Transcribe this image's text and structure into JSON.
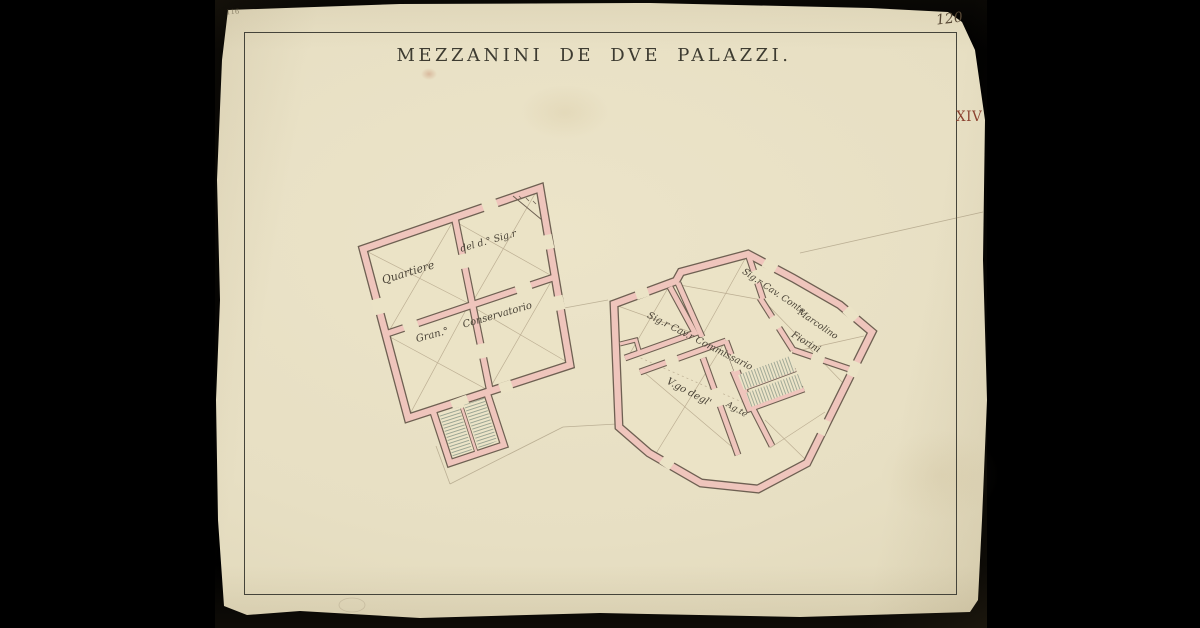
{
  "document": {
    "title": "MEZZANINI DE DVE PALAZZI.",
    "page_number": "120",
    "plate_number": "XIV",
    "corner_mark": "116",
    "type_note": "scanned archival floor-plan drawing of the mezzanines of two palaces"
  },
  "left_plan": {
    "rooms": {
      "quartiere": "Quartiere",
      "del_sig": "del d.° Sig.r",
      "gran": "Gran.°",
      "conservatorio": "Conservatorio"
    }
  },
  "right_plan": {
    "rooms": {
      "commissario": "Sig.r Cav.r Commissario",
      "conte": "Sig.r Cav. Conte",
      "marcolino": "Marcolino",
      "fiorini": "Fiorini",
      "vgo": "V.go degl'",
      "agte": "Ag.te"
    }
  },
  "colors": {
    "paper": "#e7dfc3",
    "wall_pink": "#efc5bc",
    "wall_edge": "#6e6052",
    "ink": "#3d3b31",
    "plate_red": "#8b4230",
    "stair_hatch": "#95a08f",
    "background": "#000000"
  }
}
